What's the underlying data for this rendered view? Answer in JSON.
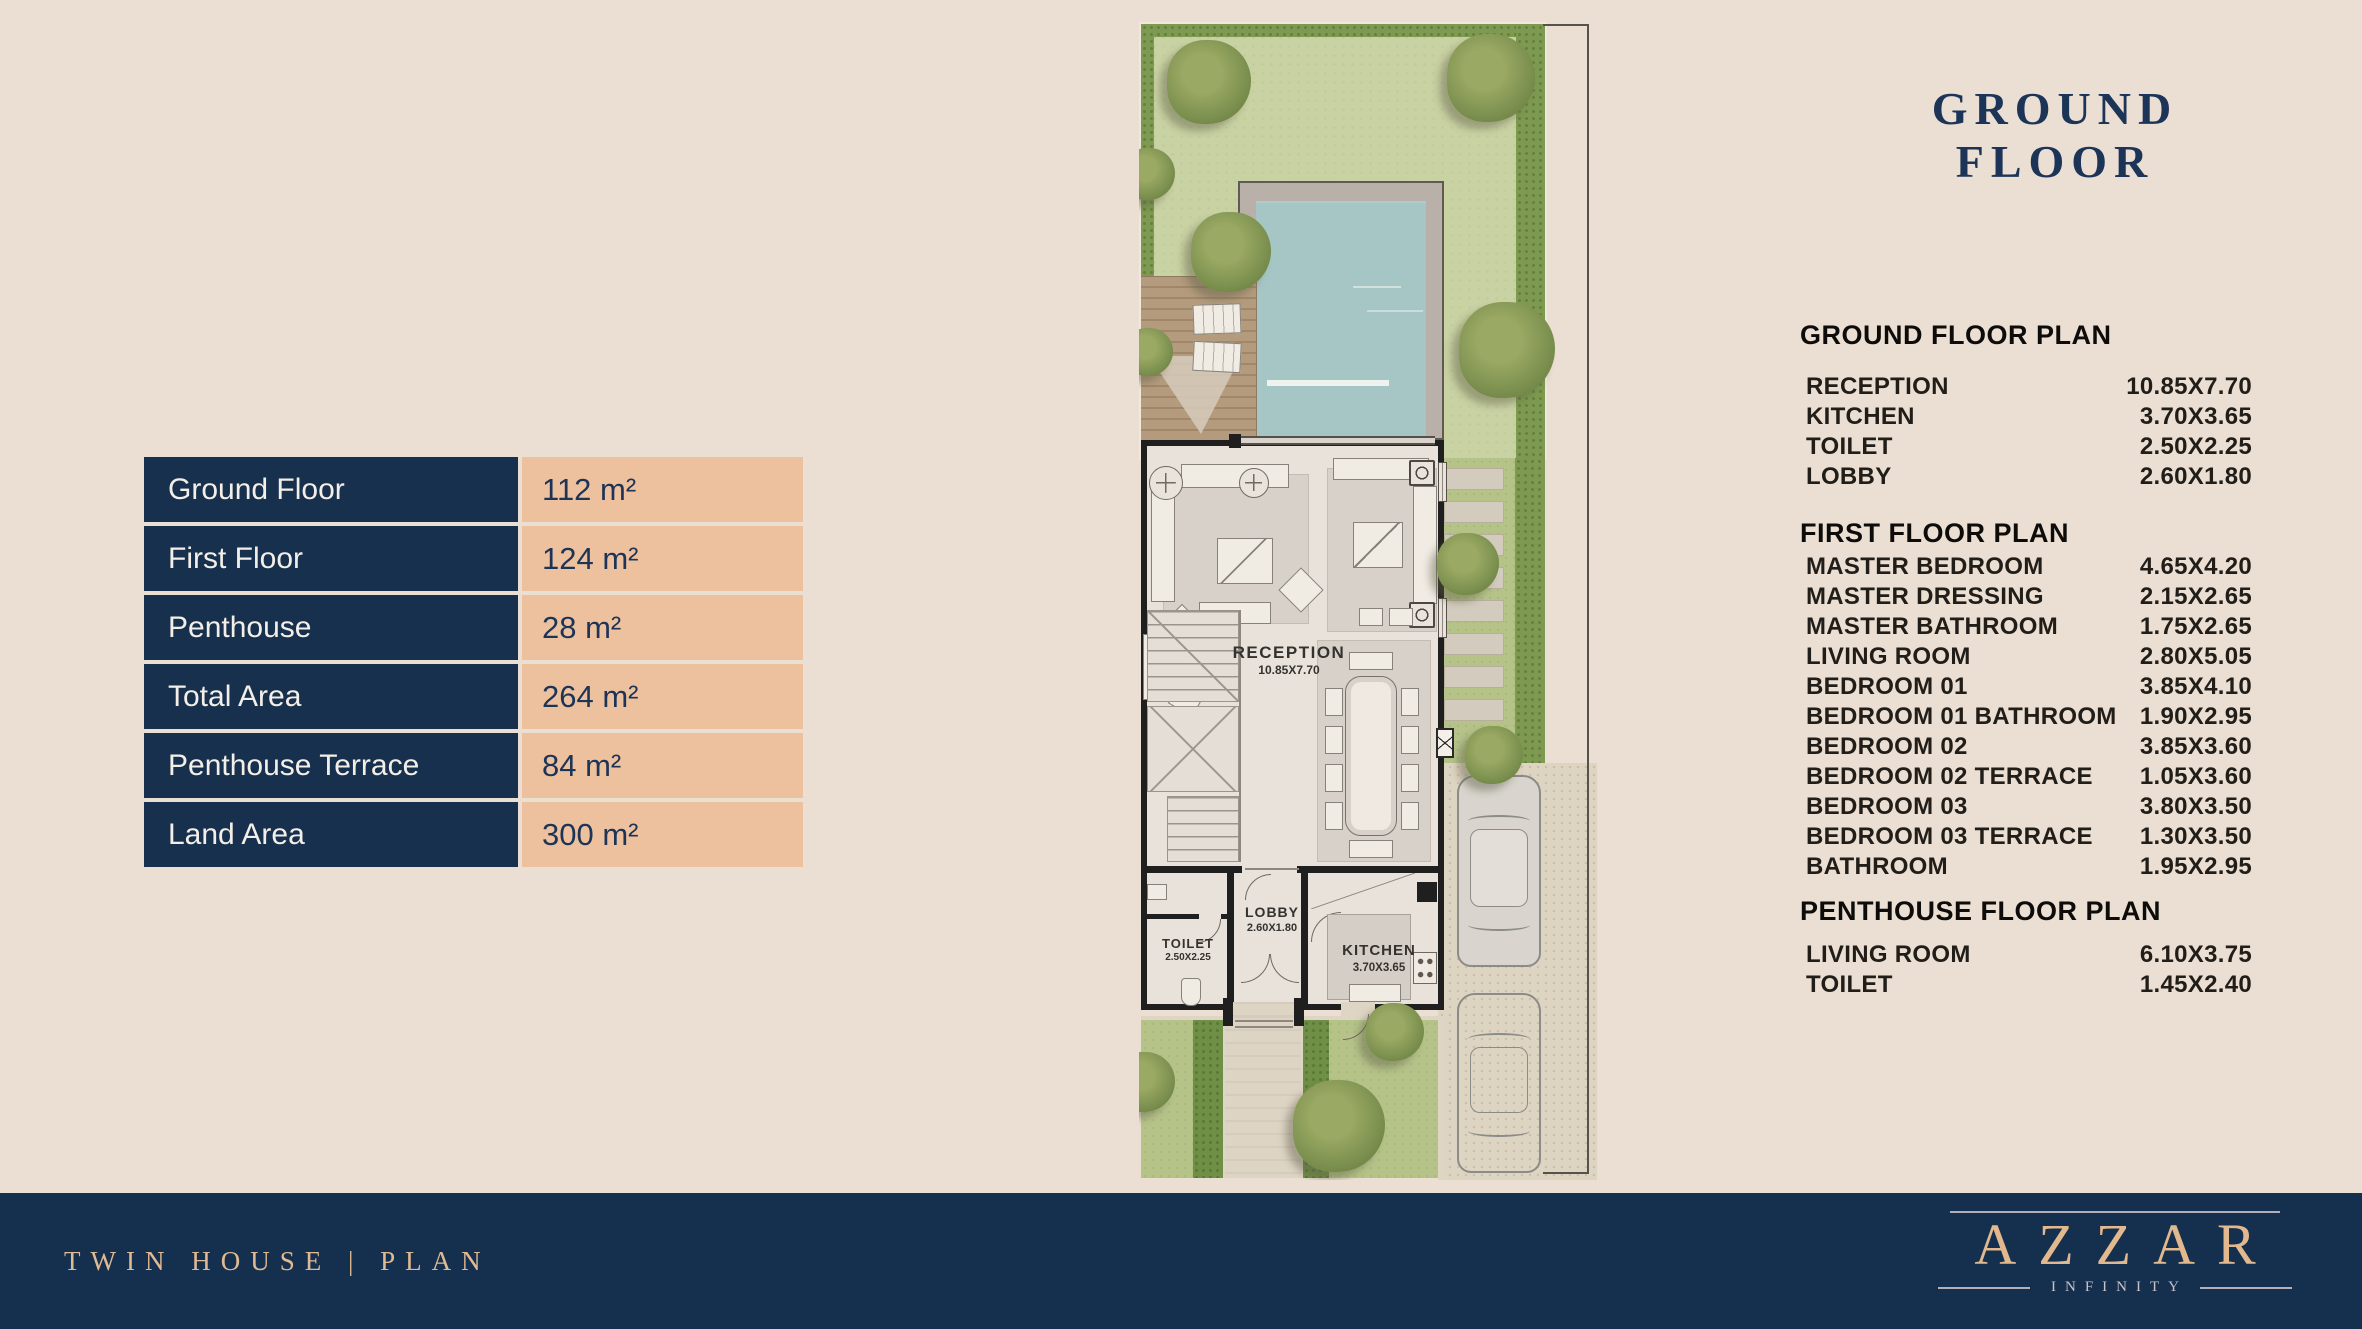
{
  "colors": {
    "page_background": "#eadfd2",
    "navy": "#16304e",
    "peach": "#edc19e",
    "title_navy": "#1c3457",
    "footer_text_peach": "#e0ba92",
    "brand_peach": "#e2b88f"
  },
  "area_table": {
    "rows": [
      {
        "label": "Ground Floor",
        "value": "112 m²"
      },
      {
        "label": "First Floor",
        "value": "124 m²"
      },
      {
        "label": "Penthouse",
        "value": "28 m²"
      },
      {
        "label": "Total Area",
        "value": "264 m²"
      },
      {
        "label": "Penthouse Terrace",
        "value": "84 m²"
      },
      {
        "label": "Land Area",
        "value": "300 m²"
      }
    ]
  },
  "floor_title": "GROUND FLOOR",
  "room_panel": {
    "sections": [
      {
        "heading": "GROUND FLOOR PLAN",
        "rooms": [
          {
            "name": "RECEPTION",
            "dim": "10.85X7.70"
          },
          {
            "name": "KITCHEN",
            "dim": "3.70X3.65"
          },
          {
            "name": "TOILET",
            "dim": "2.50X2.25"
          },
          {
            "name": "LOBBY",
            "dim": "2.60X1.80"
          }
        ]
      },
      {
        "heading": "FIRST FLOOR PLAN",
        "rooms": [
          {
            "name": "MASTER BEDROOM",
            "dim": "4.65X4.20"
          },
          {
            "name": "MASTER DRESSING",
            "dim": "2.15X2.65"
          },
          {
            "name": "MASTER BATHROOM",
            "dim": "1.75X2.65"
          },
          {
            "name": "LIVING ROOM",
            "dim": "2.80X5.05"
          },
          {
            "name": "BEDROOM 01",
            "dim": "3.85X4.10"
          },
          {
            "name": "BEDROOM 01 BATHROOM",
            "dim": "1.90X2.95"
          },
          {
            "name": "BEDROOM 02",
            "dim": "3.85X3.60"
          },
          {
            "name": "BEDROOM 02 TERRACE",
            "dim": "1.05X3.60"
          },
          {
            "name": "BEDROOM 03",
            "dim": "3.80X3.50"
          },
          {
            "name": "BEDROOM 03 TERRACE",
            "dim": "1.30X3.50"
          },
          {
            "name": "BATHROOM",
            "dim": "1.95X2.95"
          }
        ]
      },
      {
        "heading": "PENTHOUSE FLOOR PLAN",
        "rooms": [
          {
            "name": "LIVING ROOM",
            "dim": "6.10X3.75"
          },
          {
            "name": "TOILET",
            "dim": "1.45X2.40"
          }
        ]
      }
    ]
  },
  "plan": {
    "labels": {
      "reception": {
        "name": "RECEPTION",
        "dim": "10.85X7.70"
      },
      "lobby": {
        "name": "LOBBY",
        "dim": "2.60X1.80"
      },
      "toilet": {
        "name": "TOILET",
        "dim": "2.50X2.25"
      },
      "kitchen": {
        "name": "KITCHEN",
        "dim": "3.70X3.65"
      }
    }
  },
  "footer": {
    "left_text": "TWIN HOUSE | PLAN",
    "brand": "AZZAR",
    "brand_sub": "INFINITY"
  }
}
